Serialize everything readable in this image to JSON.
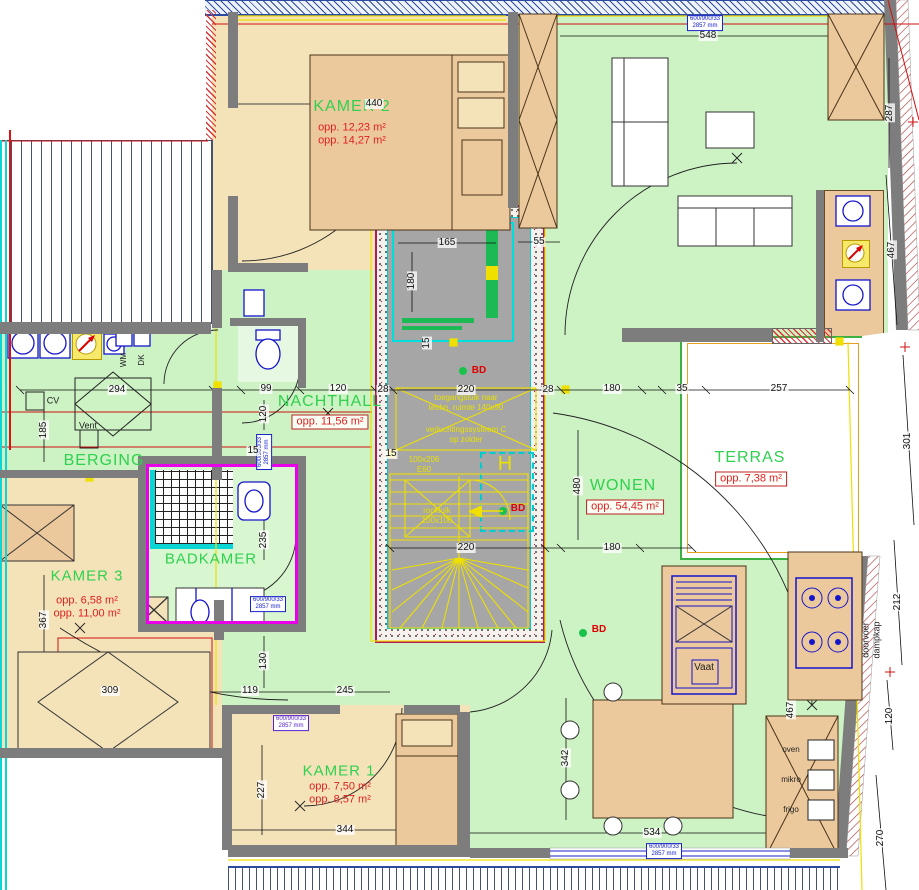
{
  "rooms": {
    "kamer2": {
      "name": "KAMER 2",
      "area1": "opp. 12,23 m²",
      "area2": "opp. 14,27 m²"
    },
    "nachthall": {
      "name": "NACHTHALL",
      "area": "opp. 11,56 m²"
    },
    "berging": {
      "name": "BERGING"
    },
    "badkamer": {
      "name": "BADKAMER"
    },
    "kamer3": {
      "name": "KAMER 3",
      "area1": "opp. 6,58 m²",
      "area2": "opp. 11,00 m²"
    },
    "kamer1": {
      "name": "KAMER 1",
      "area1": "opp. 7,50 m²",
      "area2": "opp. 8,57 m²"
    },
    "wonen": {
      "name": "WONEN",
      "area": "opp. 54,45 m²"
    },
    "terras": {
      "name": "TERRAS",
      "area": "opp. 7,38 m²"
    }
  },
  "annotations": {
    "toegang_l1": "toegangsluik naar",
    "toegang_l2": "techn. ruimte 140x90",
    "vent_l1": "verluchtingssysteem C",
    "vent_l2": "op zolder",
    "door_l1": "100x206",
    "door_l2": "E60",
    "rook_l1": "rookluik",
    "rook_l2": "100x100",
    "window_l1": "600/900/33",
    "window_l2": "2857 mm",
    "h": "H",
    "bd": "BD"
  },
  "labels": {
    "cv": "CV",
    "vent": "Vent",
    "wm": "WM",
    "dk": "DK",
    "vaat": "Vaat",
    "oven": "oven",
    "mikro": "mikro",
    "frigo": "frigo",
    "dampkap_l1": "doorvoer",
    "dampkap_l2": "dampkap"
  },
  "dims": {
    "top_kamer2": "440",
    "top_wonen": "548",
    "right_287": "287",
    "right_467a": "467",
    "right_467b": "467",
    "right_301": "301",
    "right_212": "212",
    "right_120": "120",
    "right_270": "270",
    "shaft_165": "165",
    "shaft_180v": "180",
    "top_55": "55",
    "chain_294": "294",
    "chain_99": "99",
    "chain_120": "120",
    "chain_28l": "28",
    "chain_220": "220",
    "chain_28r": "28",
    "chain_180": "180",
    "chain_35": "35",
    "chain_257": "257",
    "mid_220": "220",
    "mid_180": "180",
    "left_185": "185",
    "left_367": "367",
    "left_130": "130",
    "left_119": "119",
    "left_309": "309",
    "left_245": "245",
    "k1_227": "227",
    "k1_344": "344",
    "bottom_534": "534",
    "wonen_342": "342",
    "wonen_480": "480",
    "bad_15a": "15",
    "bad_15b": "15",
    "bad_235": "235",
    "shaft_15": "15",
    "wc_120": "120"
  }
}
